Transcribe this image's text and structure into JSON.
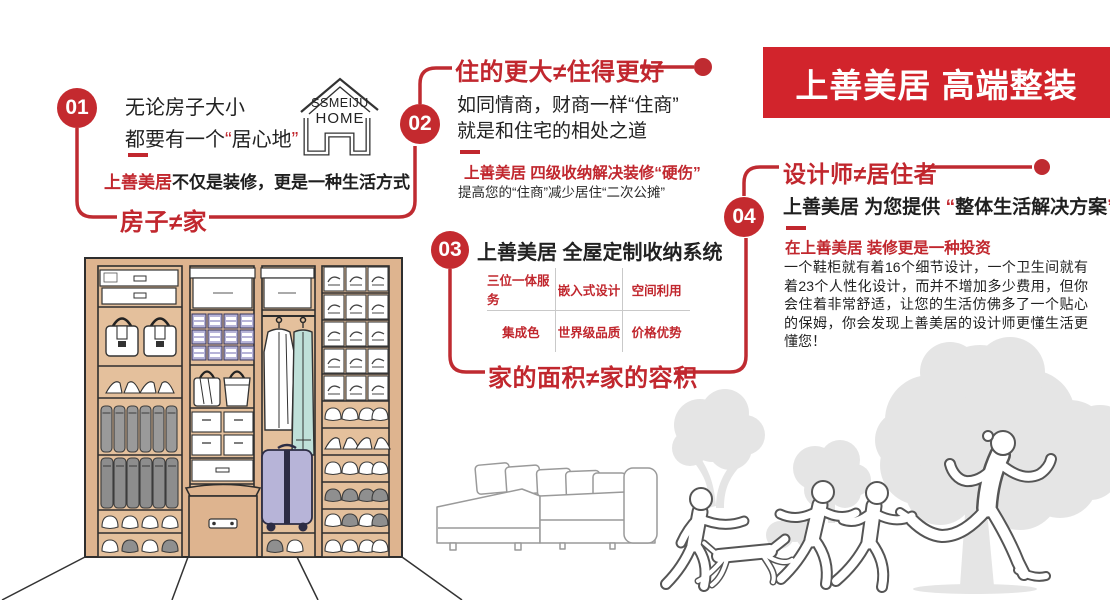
{
  "colors": {
    "brand_red": "#c1272e",
    "banner_red": "#d2242c",
    "circle_red": "#c42a2f",
    "wardrobe_tan": "#deb48f",
    "lavender": "#b7b4d8",
    "teal": "#bfe0d9",
    "silhouette_gray": "#e5e5e5"
  },
  "banner": {
    "title": "上善美居 高端整装"
  },
  "logo": {
    "line1": "SSMEIJU",
    "line2": "HOME"
  },
  "punct": {
    "open": "“",
    "close": "”"
  },
  "sections": {
    "s1": {
      "num": "01",
      "line1": "无论房子大小",
      "line2_pre": "都要有一个",
      "line2_quoted": "居心地",
      "tag_red": "上善美居",
      "tag_rest": "不仅是装修，更是一种生活方式",
      "heading": "房子≠家"
    },
    "s2": {
      "num": "02",
      "heading": "住的更大≠住得更好",
      "line1": "如同情商，财商一样“住商”",
      "line2": "就是和住宅的相处之道",
      "sub_red": "上善美居 四级收纳解决装修“硬伤”",
      "sub_black": "提高您的“住商”减少居住“二次公摊”"
    },
    "s3": {
      "num": "03",
      "title": "上善美居 全屋定制收纳系统",
      "grid": [
        "三位一体服务",
        "嵌入式设计",
        "空间利用",
        "集成色",
        "世界级品质",
        "价格优势"
      ],
      "heading": "家的面积≠家的容积"
    },
    "s4": {
      "num": "04",
      "heading": "设计师≠居住者",
      "intro_bold": "上善美居 为您提供 ",
      "intro_quoted": "整体生活解决方案",
      "sub_red": "在上善美居 装修更是一种投资",
      "body": "一个鞋柜就有着16个细节设计，一个卫生间就有着23个人性化设计，而并不增加多少费用，但你会住着非常舒适，让您的生活仿佛多了一个贴心的保姆，你会发现上善美居的设计师更懂生活更懂您！"
    }
  }
}
